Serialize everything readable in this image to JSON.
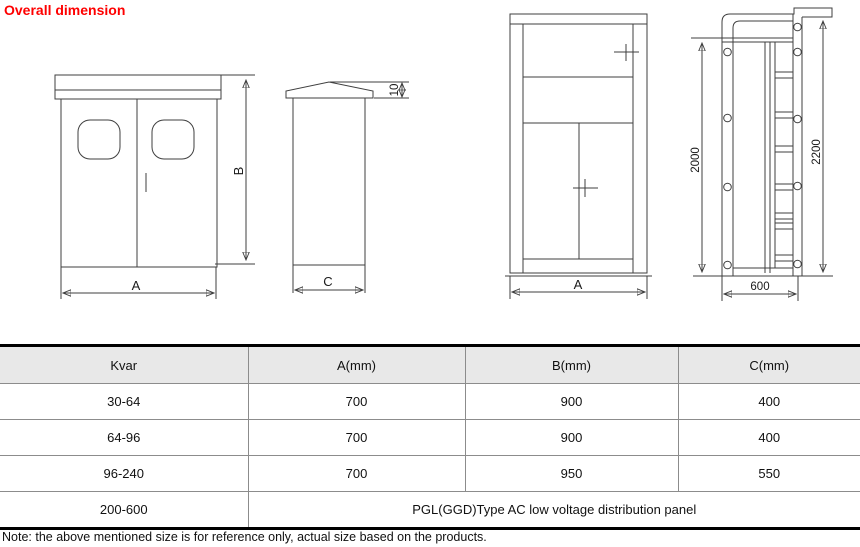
{
  "title": "Overall dimension",
  "colors": {
    "title_red": "#fe0000",
    "line": "#3f3f3f",
    "table_header_bg": "#e8e8e8",
    "table_grid": "#8c8c8c",
    "table_frame": "#000000"
  },
  "drawings": {
    "cabinet_front": {
      "width_label": "A",
      "height_label": "B"
    },
    "cabinet_side": {
      "depth_label": "C",
      "cap_height_label": "10"
    },
    "panel_front": {
      "width_label": "A"
    },
    "panel_side": {
      "inner_height_label": "2000",
      "total_height_label": "2200",
      "depth_label": "600"
    }
  },
  "table": {
    "headers": [
      "Kvar",
      "A(mm)",
      "B(mm)",
      "C(mm)"
    ],
    "rows": [
      [
        "30-64",
        "700",
        "900",
        "400"
      ],
      [
        "64-96",
        "700",
        "900",
        "400"
      ],
      [
        "96-240",
        "700",
        "950",
        "550"
      ]
    ],
    "last_row": {
      "kvar": "200-600",
      "description": "PGL(GGD)Type AC low voltage distribution panel"
    }
  },
  "note": "Note: the above mentioned size is for reference only, actual size based on the products."
}
